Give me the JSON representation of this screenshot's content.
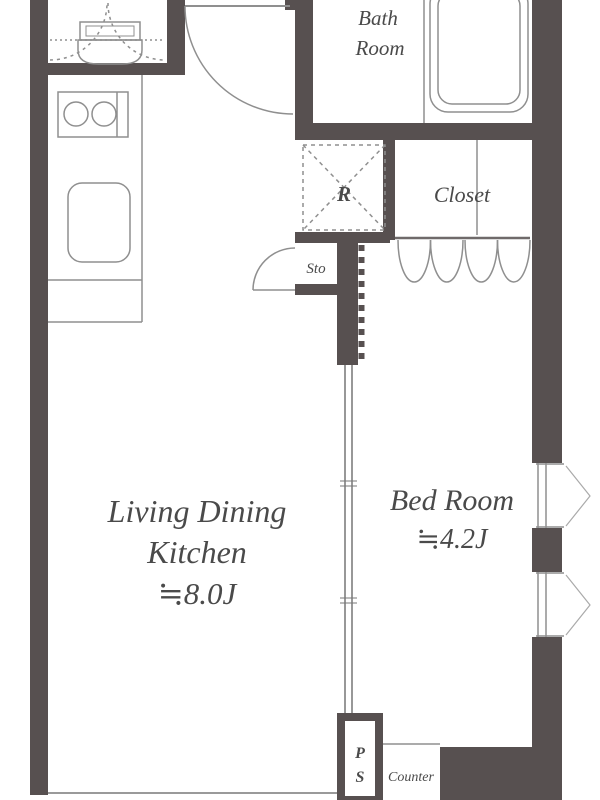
{
  "plan": {
    "type": "apartment-floor-plan",
    "labels": {
      "bath_line1": "Bath",
      "bath_line2": "Room",
      "refrigerator": "R",
      "closet": "Closet",
      "storage": "Sto",
      "ldk_line1": "Living Dining",
      "ldk_line2": "Kitchen",
      "ldk_size": "≒8.0J",
      "bedroom": "Bed Room",
      "bedroom_size": "≒4.2J",
      "pipe_space_line1": "P",
      "pipe_space_line2": "S",
      "counter": "Counter"
    }
  },
  "colors": {
    "wall": "#575050",
    "line": "#8f8f8f",
    "line_light": "#aaaaaa",
    "line_dark": "#6f6a6a",
    "text": "#4a4a4a",
    "bg": "#ffffff"
  }
}
